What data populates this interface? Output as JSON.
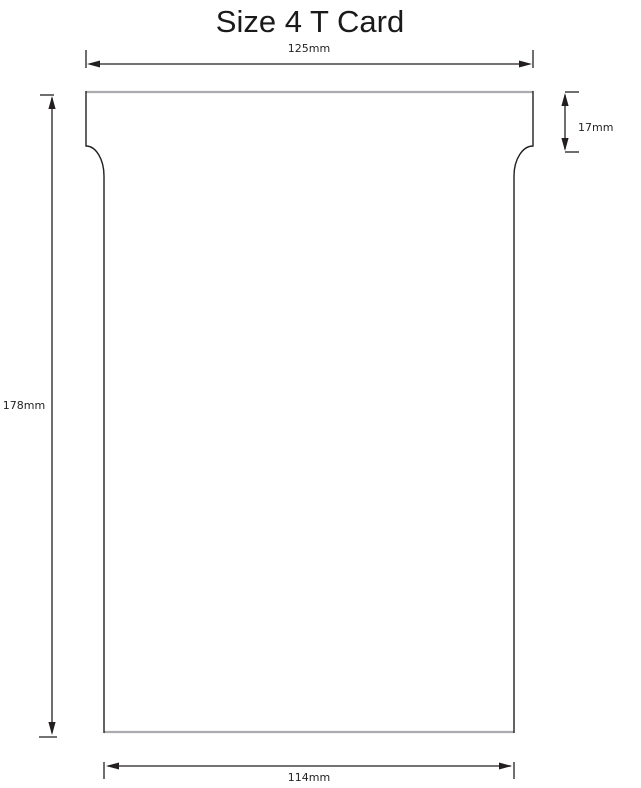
{
  "title": "Size 4 T Card",
  "colors": {
    "line": "#231f20",
    "card_edge": "#a9abae",
    "background": "#ffffff"
  },
  "dimensions": {
    "top_width": {
      "label": "125mm",
      "value_mm": 125
    },
    "tab_height": {
      "label": "17mm",
      "value_mm": 17
    },
    "total_height": {
      "label": "178mm",
      "value_mm": 178
    },
    "bottom_width": {
      "label": "114mm",
      "value_mm": 114
    }
  }
}
